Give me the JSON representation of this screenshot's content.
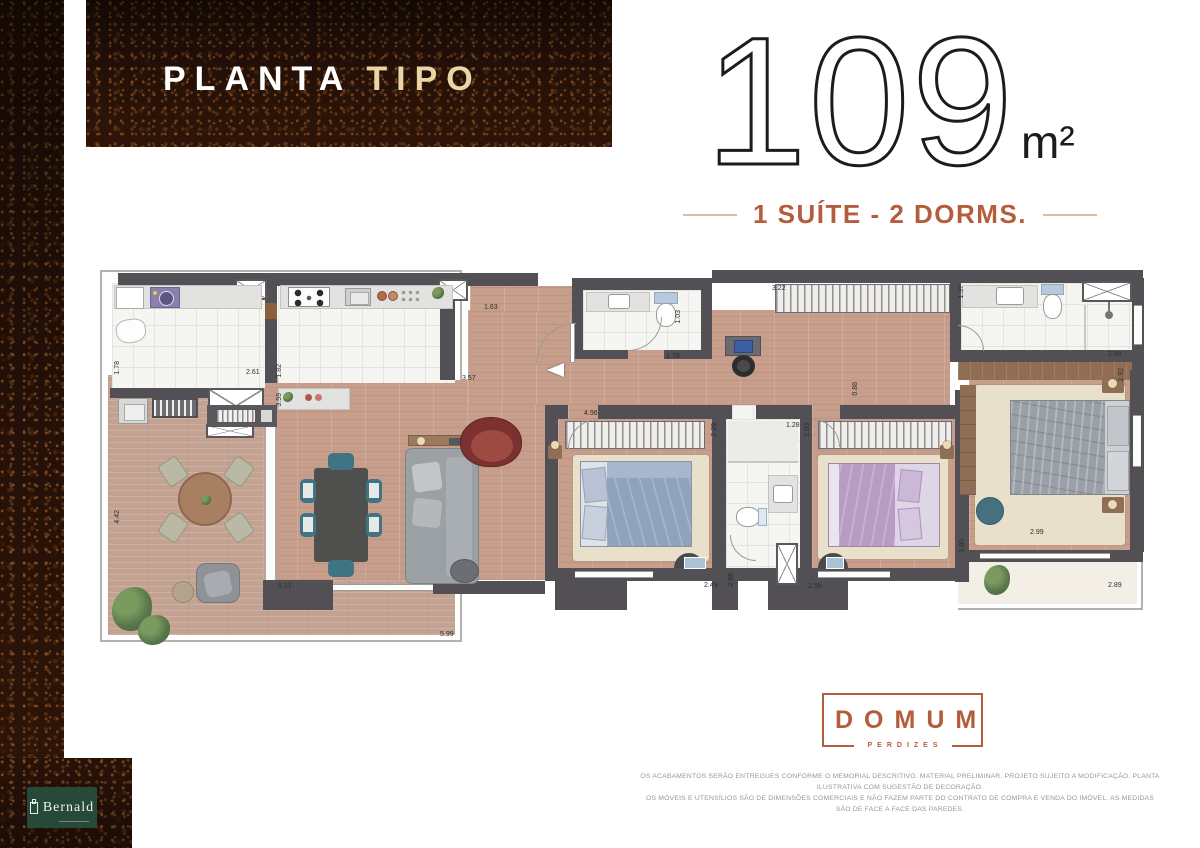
{
  "header": {
    "title_primary": "PLANTA",
    "title_secondary": "TIPO"
  },
  "area": {
    "value": "109",
    "unit": "m²",
    "subtitle": "1 SUÍTE - 2 DORMS."
  },
  "branding": {
    "logo_title": "DOMUM",
    "logo_subtitle": "PERDIZES",
    "developer": "Bernald"
  },
  "disclaimer": {
    "line1": "OS ACABAMENTOS SERÃO ENTREGUES CONFORME O MEMORIAL DESCRITIVO. MATERIAL PRELIMINAR. PROJETO SUJEITO A MODIFICAÇÃO. PLANTA ILUSTRATIVA COM SUGESTÃO DE DECORAÇÃO.",
    "line2": "OS MÓVEIS E UTENSÍLIOS SÃO DE DIMENSÕES COMERCIAIS E NÃO FAZEM PARTE DO CONTRATO DE COMPRA E VENDA DO IMÓVEL. AS MEDIDAS SÃO DE FACE A FACE DAS PAREDES."
  },
  "colors": {
    "accent_terracotta": "#b45c3c",
    "title_cream": "#e9d5a6",
    "wall_gray": "#525055",
    "bernald_green": "#27493a"
  },
  "plan": {
    "dims": [
      {
        "v": "1.78",
        "x": 14,
        "y": 96,
        "r": 1
      },
      {
        "v": "2.61",
        "x": 146,
        "y": 104
      },
      {
        "v": "1.82",
        "x": 176,
        "y": 99,
        "r": 1
      },
      {
        "v": "3.59",
        "x": 176,
        "y": 128,
        "r": 1
      },
      {
        "v": "3.57",
        "x": 362,
        "y": 110
      },
      {
        "v": "1.63",
        "x": 384,
        "y": 39
      },
      {
        "v": "1.03",
        "x": 575,
        "y": 45,
        "r": 1
      },
      {
        "v": "1.79",
        "x": 566,
        "y": 88
      },
      {
        "v": "3.22",
        "x": 672,
        "y": 20
      },
      {
        "v": "1.37",
        "x": 858,
        "y": 20,
        "r": 1
      },
      {
        "v": "2.98",
        "x": 1008,
        "y": 86
      },
      {
        "v": "2.92",
        "x": 1018,
        "y": 103,
        "r": 1
      },
      {
        "v": "0.88",
        "x": 752,
        "y": 117,
        "r": 1
      },
      {
        "v": "4.96",
        "x": 484,
        "y": 145
      },
      {
        "v": "2.29",
        "x": 611,
        "y": 158,
        "r": 1
      },
      {
        "v": "2.03",
        "x": 704,
        "y": 158,
        "r": 1
      },
      {
        "v": "1.28",
        "x": 686,
        "y": 157
      },
      {
        "v": "2.49",
        "x": 604,
        "y": 317
      },
      {
        "v": "2.88",
        "x": 628,
        "y": 308,
        "r": 1
      },
      {
        "v": "2.59",
        "x": 708,
        "y": 318
      },
      {
        "v": "2.99",
        "x": 930,
        "y": 264
      },
      {
        "v": "0.80",
        "x": 859,
        "y": 274,
        "r": 1
      },
      {
        "v": "2.89",
        "x": 1008,
        "y": 317
      },
      {
        "v": "4.42",
        "x": 14,
        "y": 245,
        "r": 1
      },
      {
        "v": "5.31",
        "x": 178,
        "y": 318
      },
      {
        "v": "5.99",
        "x": 340,
        "y": 366
      }
    ]
  }
}
